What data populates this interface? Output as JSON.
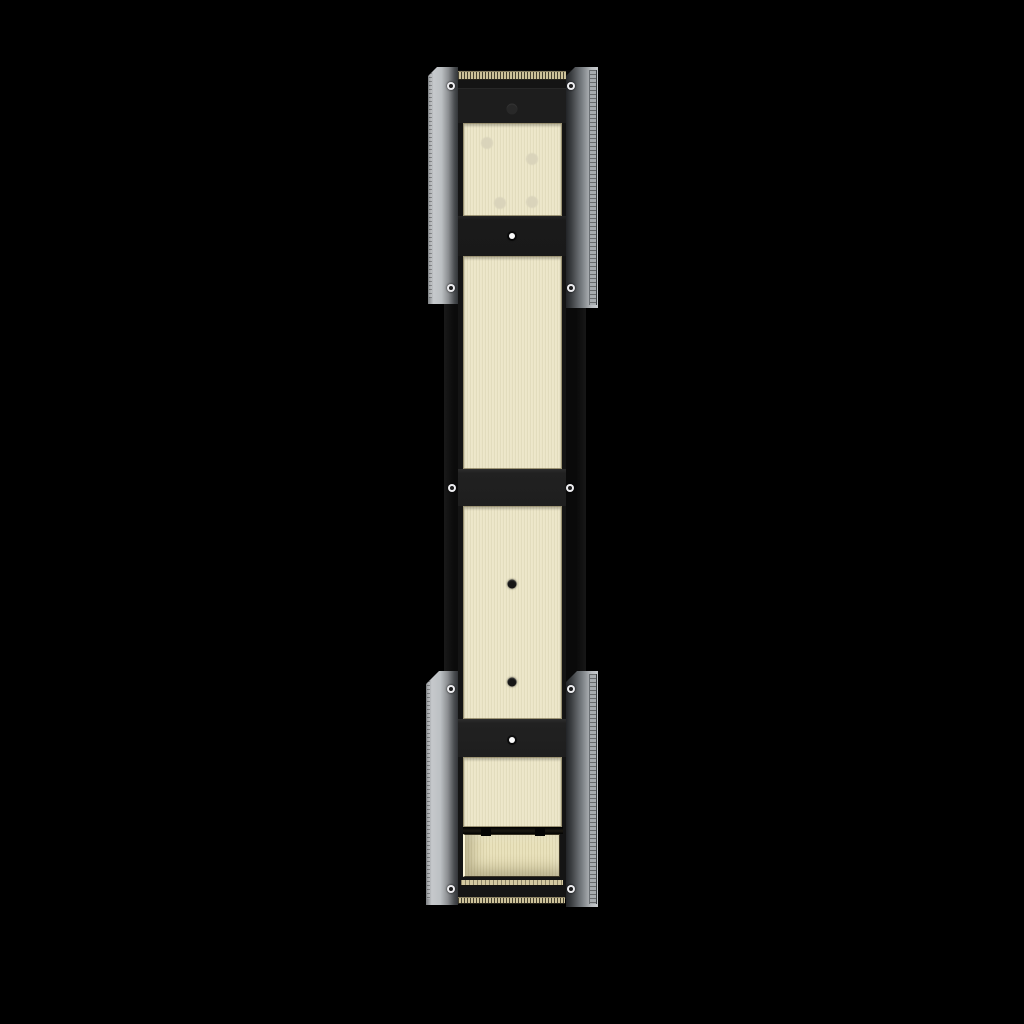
{
  "scene": {
    "type": "3d-product-render",
    "description": "Front view of a tall vertical wall-mount bracket assembly on a pure black background: a black mounting rail with brushed ivory-brass inlay panels, tan brush-seal strips at top and bottom, a recessed tray near the bottom, flanked by four brushed-steel side plates fastened with rivets",
    "background_color": "#000000",
    "colors": {
      "background": "#000000",
      "rail_black": "#0b0b0b",
      "rail_inner": "#141414",
      "crossbar_gray": "#1e1e1e",
      "panel_cream": "#ece6c8",
      "recess_cream": "#e8e0b8",
      "brush_tan": "#cdc29a",
      "strip_tan": "#d3c89f",
      "plate_silver_light": "#c6c9cc",
      "plate_silver_dark": "#3a3d40",
      "rivet_white": "#ededf0",
      "faint_dot": "#d9d3ba"
    },
    "parts": [
      {
        "name": "upper-left-steel-plate"
      },
      {
        "name": "upper-right-steel-plate"
      },
      {
        "name": "lower-left-steel-plate"
      },
      {
        "name": "lower-right-steel-plate"
      },
      {
        "name": "black-mounting-rail"
      },
      {
        "name": "top-brush-seal-strip"
      },
      {
        "name": "cream-panel-1"
      },
      {
        "name": "cream-panel-2"
      },
      {
        "name": "cream-panel-3"
      },
      {
        "name": "cream-panel-4"
      },
      {
        "name": "middle-crossbar"
      },
      {
        "name": "lower-crossbar"
      },
      {
        "name": "recessed-tray"
      },
      {
        "name": "bottom-brush-seal-strip"
      }
    ],
    "features": {
      "plate_rivets": [
        {
          "x": 451,
          "y": 86
        },
        {
          "x": 571,
          "y": 86
        },
        {
          "x": 451,
          "y": 288
        },
        {
          "x": 571,
          "y": 288
        },
        {
          "x": 451,
          "y": 689
        },
        {
          "x": 571,
          "y": 689
        },
        {
          "x": 451,
          "y": 889
        },
        {
          "x": 571,
          "y": 889
        }
      ],
      "rail_rivets": [
        {
          "x": 452,
          "y": 488
        },
        {
          "x": 570,
          "y": 488
        }
      ],
      "white_dots": [
        {
          "x": 512,
          "y": 236
        },
        {
          "x": 512,
          "y": 740
        }
      ],
      "black_dots": [
        {
          "x": 512,
          "y": 584
        },
        {
          "x": 512,
          "y": 682
        }
      ],
      "dim_dots": [
        {
          "x": 512,
          "y": 109
        }
      ],
      "faint_dots": [
        {
          "x": 487,
          "y": 143
        },
        {
          "x": 532,
          "y": 159
        },
        {
          "x": 500,
          "y": 203
        },
        {
          "x": 532,
          "y": 202
        }
      ]
    }
  }
}
